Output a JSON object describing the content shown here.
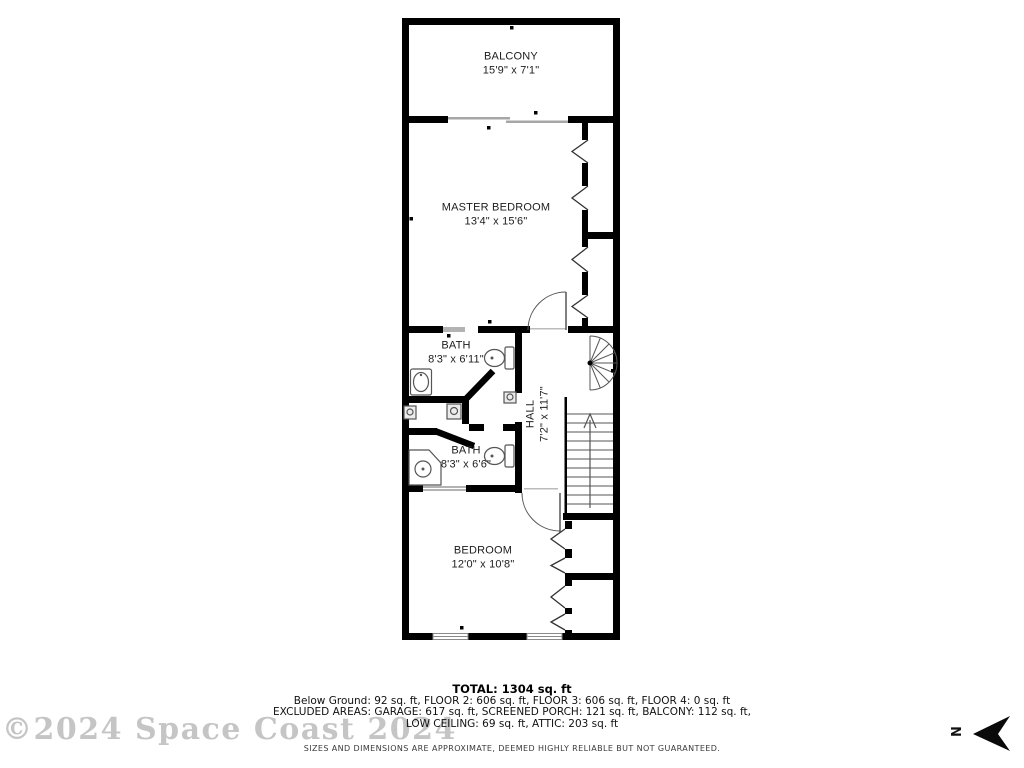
{
  "floorplan": {
    "rooms": {
      "balcony": {
        "name": "BALCONY",
        "dims": "15'9\" x 7'1\""
      },
      "master_bedroom": {
        "name": "MASTER BEDROOM",
        "dims": "13'4\" x 15'6\""
      },
      "bath_upper": {
        "name": "BATH",
        "dims": "8'3\" x 6'11\""
      },
      "hall": {
        "name": "HALL",
        "dims": "7'2\" x 11'7\""
      },
      "bath_lower": {
        "name": "BATH",
        "dims": "8'3\" x 6'6\""
      },
      "bedroom": {
        "name": "BEDROOM",
        "dims": "12'0\" x 10'8\""
      }
    },
    "north_label": "N"
  },
  "summary": {
    "total": "TOTAL: 1304 sq. ft",
    "line1": "Below Ground: 92 sq. ft, FLOOR 2: 606 sq. ft, FLOOR 3: 606 sq. ft, FLOOR 4: 0 sq. ft",
    "line2": "EXCLUDED AREAS: GARAGE: 617 sq. ft, SCREENED PORCH: 121 sq. ft, BALCONY: 112 sq. ft,",
    "line3": "LOW CEILING: 69 sq. ft, ATTIC: 203 sq. ft"
  },
  "disclaimer": "SIZES AND DIMENSIONS ARE APPROXIMATE, DEEMED HIGHLY RELIABLE BUT NOT GUARANTEED.",
  "watermark": "©2024 Space Coast 2024",
  "colors": {
    "wall": "#000000",
    "window": "#b3b3b3",
    "fixture": "#555555",
    "watermark": "#c5c5c5"
  }
}
